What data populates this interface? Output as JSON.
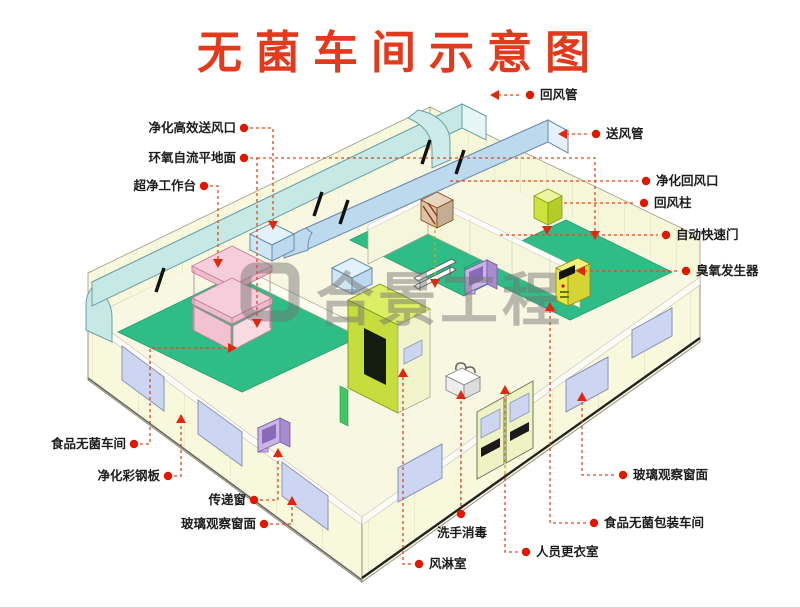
{
  "title": "无菌车间示意图",
  "watermark": {
    "text": "合景工程",
    "logo": "rounded-square-logo"
  },
  "labels": {
    "hepa_supply_vent": "净化高效送风口",
    "epoxy_floor": "环氧自流平地面",
    "clean_workbench": "超净工作台",
    "food_sterile_workshop": "食品无菌车间",
    "color_steel_panel": "净化彩钢板",
    "transfer_window": "传递窗",
    "glass_window_left": "玻璃观察窗面",
    "return_duct": "回风管",
    "supply_duct": "送风管",
    "purification_return_vent": "净化回风口",
    "return_air_column": "回风柱",
    "auto_fast_door": "自动快速门",
    "ozone_generator": "臭氧发生器",
    "glass_window_right": "玻璃观察窗面",
    "food_packaging_workshop": "食品无菌包装车间",
    "hand_wash_disinfect": "洗手消毒",
    "staff_changing_room": "人员更衣室",
    "air_shower_room": "风淋室"
  },
  "colors": {
    "title_red": "#e3391d",
    "leader_dash": "#e0481c",
    "label_dot": "#e01800",
    "floor_green": "#2fbc86",
    "return_duct_cyan": "#c6e9e6",
    "supply_duct_blue": "#bcd9ee",
    "wall_cream": "#f8f8dc",
    "window_lavender": "#ccd5f1",
    "air_shower_chartreuse": "#c6dd3e",
    "workbench_pink": "#f6cdda",
    "machine_yellow": "#e6e63e",
    "equipment_purple": "#c9b4e4",
    "watermark_gray": "#737373"
  }
}
